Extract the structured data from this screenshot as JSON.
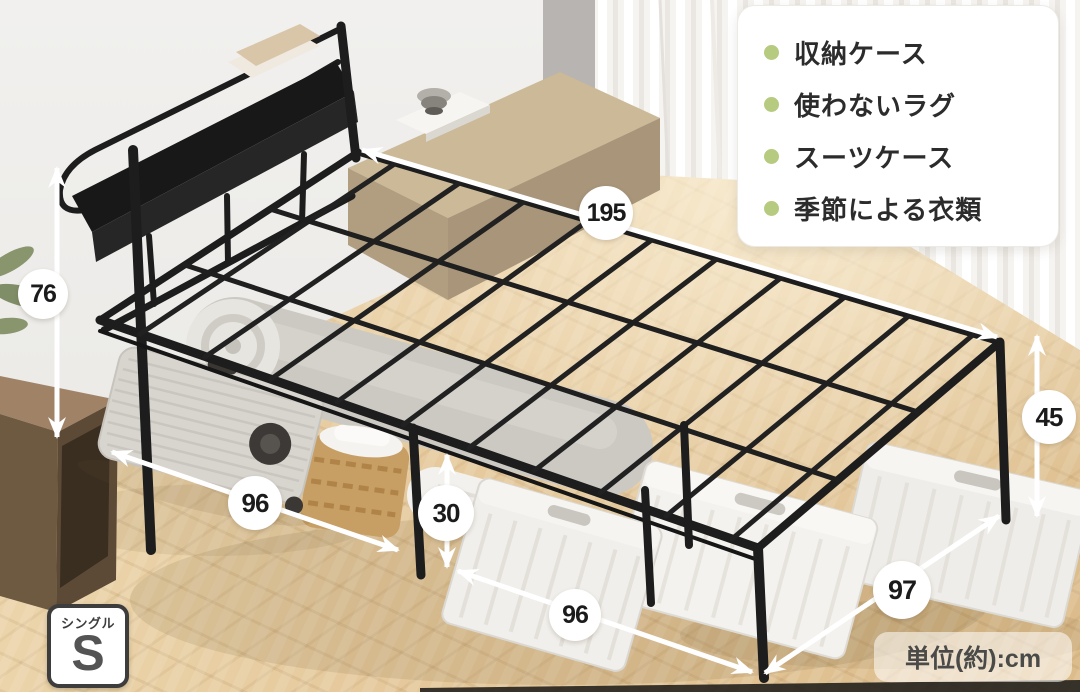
{
  "annotation_panel": {
    "items": [
      {
        "icon": "bullet-dot",
        "label": "収納ケース"
      },
      {
        "icon": "bullet-dot",
        "label": "使わないラグ"
      },
      {
        "icon": "bullet-dot",
        "label": "スーツケース"
      },
      {
        "icon": "bullet-dot",
        "label": "季節による衣類"
      }
    ]
  },
  "dimensions": [
    {
      "name": "bed-length",
      "value": "195"
    },
    {
      "name": "headboard-height",
      "value": "76"
    },
    {
      "name": "head-side-width",
      "value": "96"
    },
    {
      "name": "under-bed-clearance",
      "value": "30"
    },
    {
      "name": "foot-side-width",
      "value": "96"
    },
    {
      "name": "foot-side-depth",
      "value": "97"
    },
    {
      "name": "frame-height",
      "value": "45"
    }
  ],
  "unit_note": "単位(約):cm",
  "size_badge": {
    "label": "シングル",
    "letter": "S"
  },
  "colors": {
    "bullet_green": "#b6cb80",
    "frame_black": "#1d1d1d",
    "floor_wood": "#e5c99d",
    "wall_gray": "#edebe8",
    "annotation_white": "#ffffff"
  }
}
